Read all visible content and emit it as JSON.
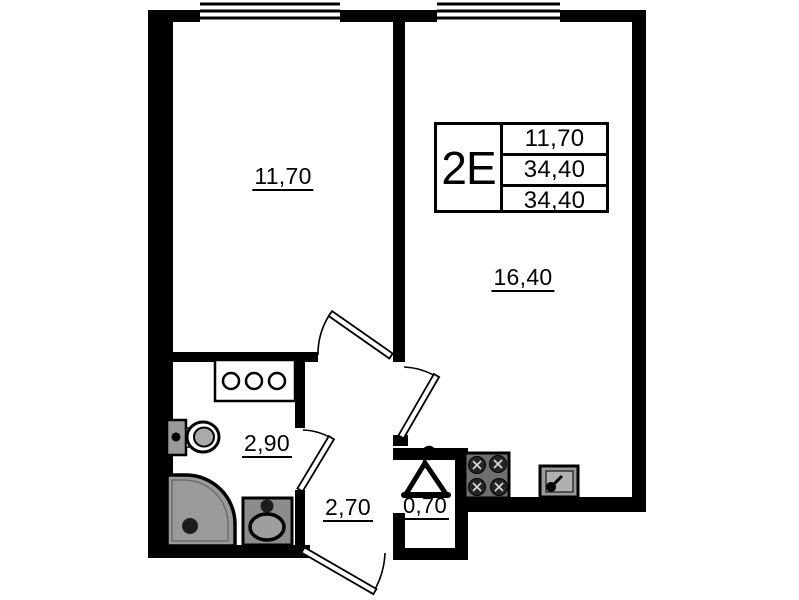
{
  "plan": {
    "unit_stamp": {
      "type": "2Е",
      "values": [
        "11,70",
        "34,40",
        "34,40"
      ]
    },
    "room_labels": {
      "bedroom": "11,70",
      "kitchen_living": "16,40",
      "bathroom": "2,90",
      "hallway": "2,70",
      "wardrobe": "0,70"
    },
    "icons": [
      "window-icon",
      "door-swing-icon",
      "toilet-icon",
      "shower-icon",
      "washbasin-icon",
      "vanity-icon",
      "stove-icon",
      "kitchen-sink-icon",
      "hanger-icon"
    ],
    "colors": {
      "wall": "#000000",
      "fixture_gray": "#9a9a9a",
      "fixture_dark": "#6f6f6f",
      "background": "#ffffff"
    }
  }
}
